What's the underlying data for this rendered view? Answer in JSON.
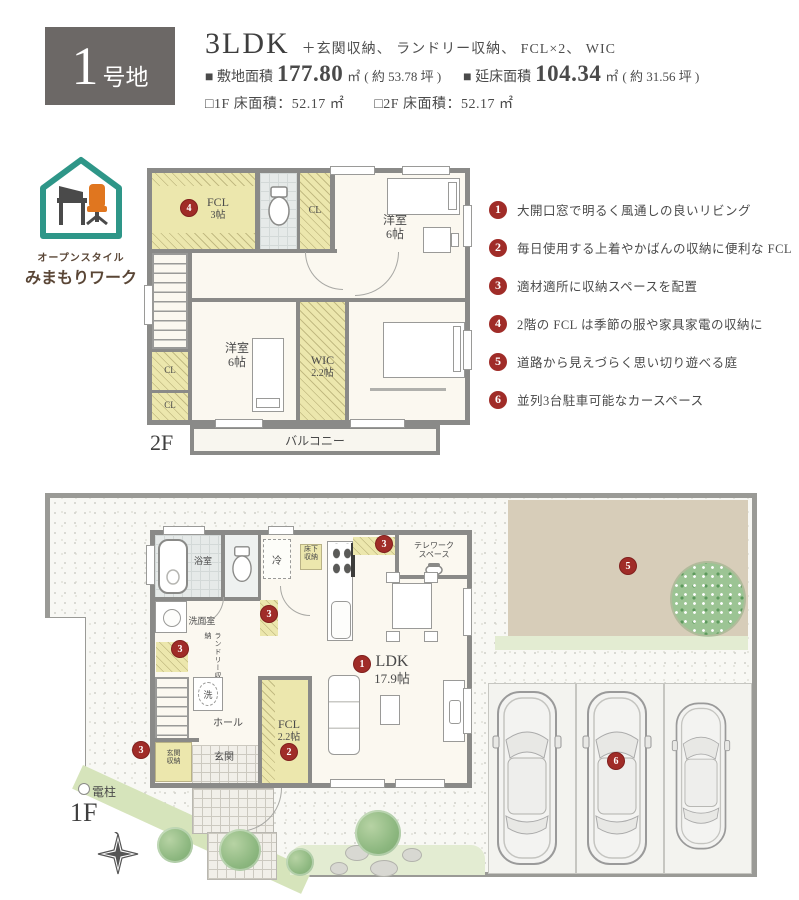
{
  "header": {
    "lot_number": "1",
    "lot_suffix": "号地",
    "plan_type": "3LDK",
    "plan_extras": "＋玄関収納、 ランドリー収納、 FCL×2、 WIC",
    "site_area_label": "■ 敷地面積",
    "site_area_value": "177.80",
    "site_area_unit": "㎡",
    "site_area_tsubo": "( 約 53.78 坪 )",
    "total_area_label": "■ 延床面積",
    "total_area_value": "104.34",
    "total_area_unit": "㎡",
    "total_area_tsubo": "( 約 31.56 坪 )",
    "floor1_area": "□1F 床面積：52.17 ㎡",
    "floor2_area": "□2F 床面積：52.17 ㎡"
  },
  "logo": {
    "line1": "オープンスタイル",
    "line2": "みまもりワーク"
  },
  "features": [
    {
      "num": "1",
      "text": "大開口窓で明るく風通しの良いリビング"
    },
    {
      "num": "2",
      "text": "毎日使用する上着やかばんの収納に便利な FCL"
    },
    {
      "num": "3",
      "text": "適材適所に収納スペースを配置"
    },
    {
      "num": "4",
      "text": "2階の FCL は季節の服や家具家電の収納に"
    },
    {
      "num": "5",
      "text": "道路から見えづらく思い切り遊べる庭"
    },
    {
      "num": "6",
      "text": "並列3台駐車可能なカースペース"
    }
  ],
  "floor2": {
    "floor_label": "2F",
    "marker_fcl": "4",
    "fcl_name": "FCL",
    "fcl_size": "3帖",
    "cl_top": "CL",
    "cl_left1": "CL",
    "cl_left2": "CL",
    "bedroom1_name": "洋室",
    "bedroom1_size": "6帖",
    "bedroom2_name": "洋室",
    "bedroom2_size": "6帖",
    "wic_name": "WIC",
    "wic_size": "2.2帖",
    "master_name": "主寝室",
    "master_size": "7.2帖",
    "balcony": "バルコニー"
  },
  "floor1": {
    "floor_label": "1F",
    "bath": "浴室",
    "fridge": "冷",
    "underfloor_1": "床下",
    "underfloor_2": "収納",
    "telework_1": "テレワーク",
    "telework_2": "スペース",
    "washroom": "洗面室",
    "laundry_storage": "ランドリー収納",
    "washer": "洗",
    "hall": "ホール",
    "entrance": "玄関",
    "entrance_storage_1": "玄関",
    "entrance_storage_2": "収納",
    "ldk_name": "LDK",
    "ldk_size": "17.9帖",
    "fcl_name": "FCL",
    "fcl_size": "2.2帖",
    "pole": "電柱",
    "marker_ldk": "1",
    "marker_fcl": "2",
    "marker_pantry": "3",
    "marker_hall": "3",
    "marker_laundry": "3",
    "marker_entrance": "3",
    "marker_garden": "5",
    "marker_parking": "6"
  },
  "colors": {
    "accent_red": "#a02c28",
    "closet_yellow": "#ece7ad",
    "garden_tan": "#d7cdb9",
    "lawn_green": "#d9e6c0",
    "logo_teal": "#2e9688",
    "logo_orange": "#e0761f",
    "header_grey": "#6c6866"
  }
}
